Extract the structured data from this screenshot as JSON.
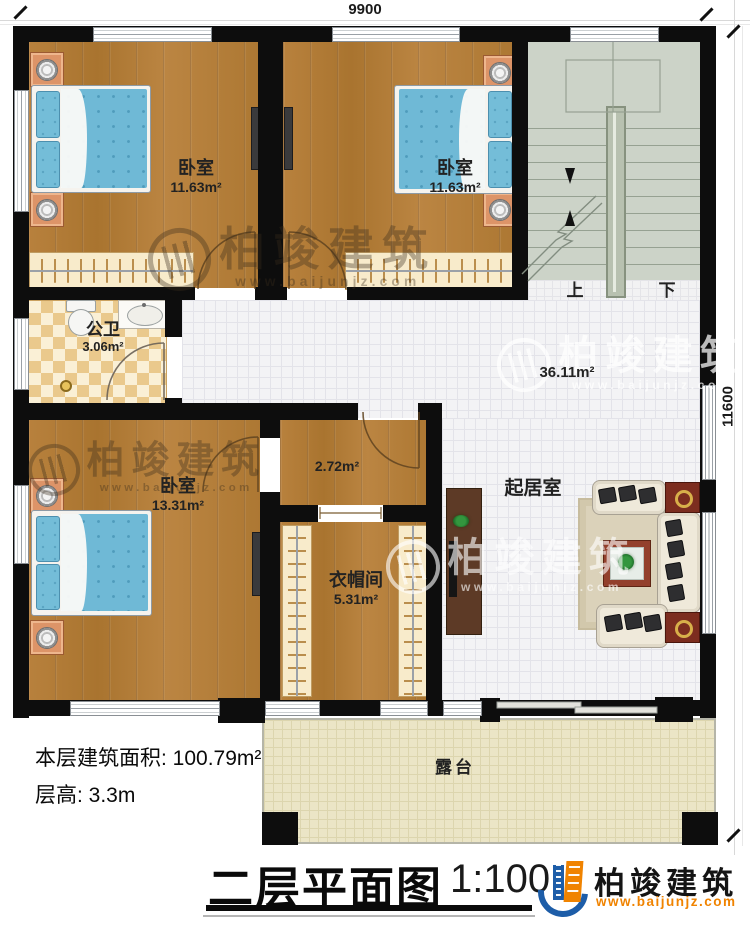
{
  "dimensions": {
    "width_label": "9900",
    "height_label": "11600"
  },
  "rooms": {
    "bedroom_tl": {
      "name": "卧室",
      "area": "11.63m²"
    },
    "bedroom_tm": {
      "name": "卧室",
      "area": "11.63m²"
    },
    "bathroom": {
      "name": "公卫",
      "area": "3.06m²"
    },
    "bedroom_bl": {
      "name": "卧室",
      "area": "13.31m²"
    },
    "hallway": {
      "area": "2.72m²"
    },
    "closet": {
      "name": "衣帽间",
      "area": "5.31m²"
    },
    "living": {
      "name": "起居室",
      "area": "36.11m²"
    },
    "terrace": {
      "name": "露台"
    }
  },
  "stairs": {
    "up_label": "上",
    "down_label": "下"
  },
  "footer": {
    "area_line": "本层建筑面积: 100.79m²",
    "height_line": "层高: 3.3m",
    "title": "二层平面图",
    "scale": "1:100"
  },
  "brand": {
    "name": "柏竣建筑",
    "website": "www.baijunjz.com"
  },
  "watermark": {
    "name": "柏竣建筑",
    "website": "www.baijunjz.com"
  },
  "colors": {
    "brand_blue": "#1d5da8",
    "brand_orange": "#f08300",
    "wall": "#0d0d0d",
    "wood_floor": "#b07a38",
    "stair": "#ccd3c8",
    "terrace": "#ebe5c6",
    "bed": "#6fb9d6"
  }
}
